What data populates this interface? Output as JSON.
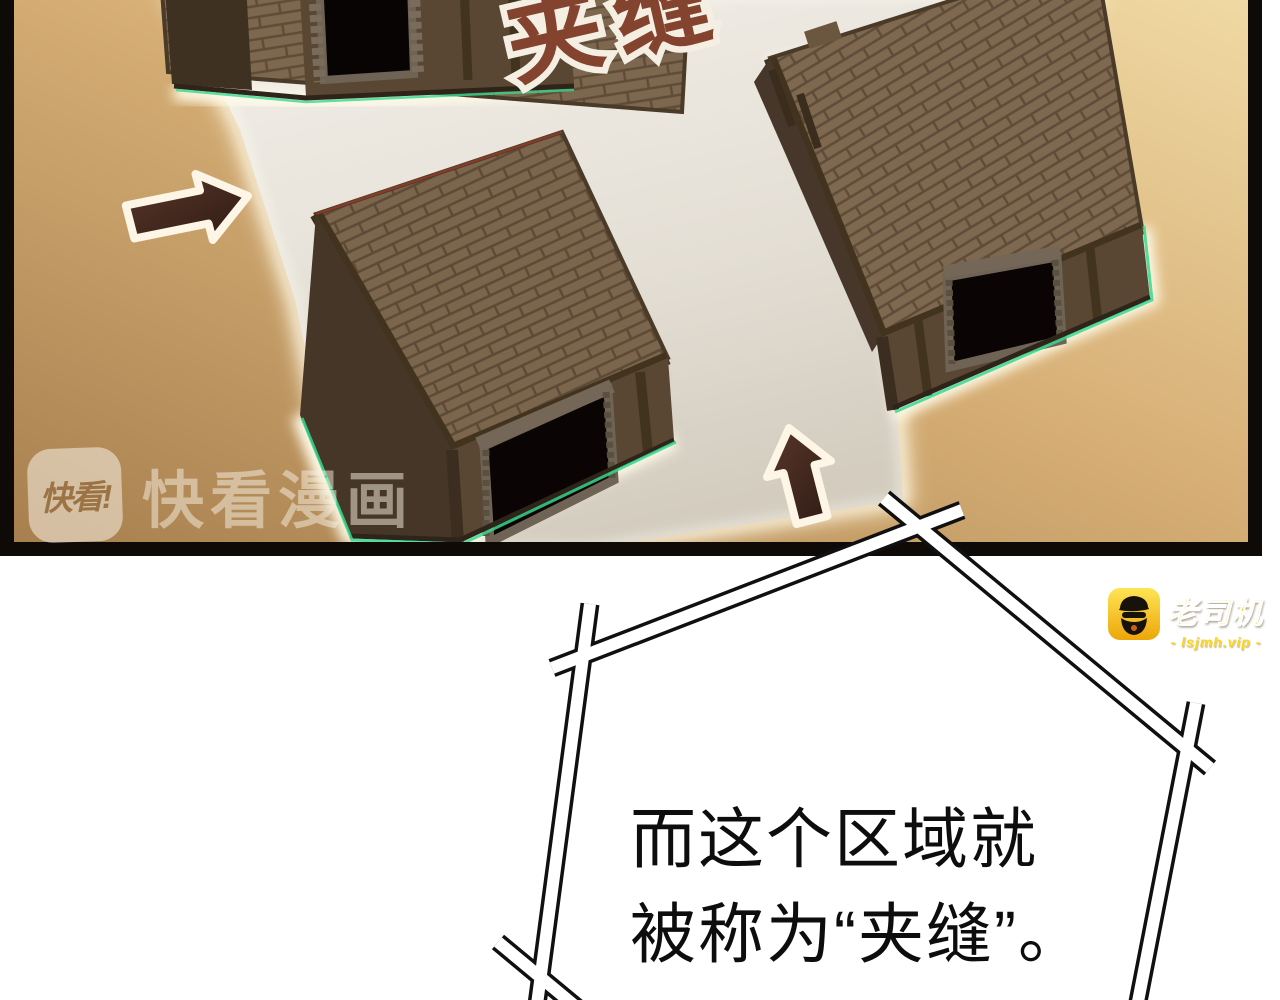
{
  "comic_panel": {
    "sfx_label": "夹缝",
    "watermark": {
      "icon_label": "快看!",
      "brand": "快看漫画"
    }
  },
  "narration_bubble": {
    "lines": [
      "而这个区域就",
      "被称为“夹缝”。"
    ]
  },
  "site_badge": {
    "brand": "老司机",
    "url_text": "- lsjmh.vip -"
  },
  "colors": {
    "sand": "#d4ab72",
    "alley_path": "#e9e5dd",
    "roof_brick": "#7d674e",
    "arrow_brown": "#492c21",
    "sfx_red_brown": "#84432f",
    "glow_green_rim": "#36d88f",
    "badge_yellow": "#ffd614",
    "panel_border": "#0d0a08"
  }
}
